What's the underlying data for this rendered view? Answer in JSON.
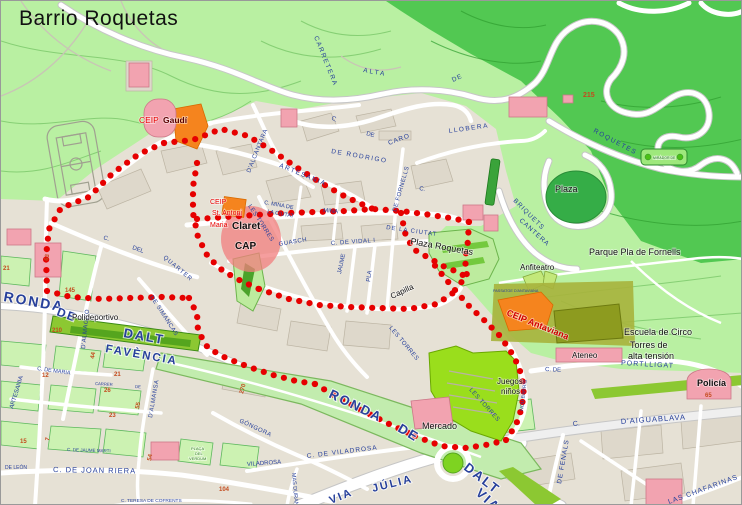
{
  "title": "Barrio Roquetas",
  "colors": {
    "parkLight": "#b9f0a2",
    "parkDark": "#52c852",
    "urban": "#e6e1d5",
    "block": "#ded8cb",
    "blockLine": "#bcb4a3",
    "greenBlock": "#ccf2b2",
    "greenBlockLine": "#5eb85e",
    "road": "#ffffff",
    "roadCase": "#c6c6c6",
    "band": "#c2ecae",
    "bandLine": "#7bb85e",
    "brightGreen": "#9ade1c",
    "sportGreen": "#8cc832",
    "sportDark": "#55a51e",
    "pink": "#f2a3b0",
    "pinkLine": "#cc7788",
    "orange": "#f5841e",
    "orangeLine": "#d86a00",
    "olive": "#8d9b1f",
    "khaki": "#a7b33c",
    "darkCircle": "#35ad47",
    "plazaGreen": "#bdeb9e",
    "plazaGreenLine": "#6cb44c",
    "contour": "#86cf74",
    "contourDark": "#2f9e2f",
    "grayTrail": "#c9c4b6",
    "blueLabel": "#27409b",
    "numColor": "#c44b1e",
    "route": "#e60000",
    "claretPink": "#f27d7d"
  },
  "route": {
    "color": "#e60000",
    "dot_radius": 3.1,
    "dot_spacing": 10.5,
    "polylines": [
      [
        [
          163,
          142
        ],
        [
          138,
          153
        ],
        [
          112,
          172
        ],
        [
          88,
          196
        ],
        [
          60,
          207
        ],
        [
          48,
          228
        ],
        [
          45,
          255
        ],
        [
          46,
          290
        ]
      ],
      [
        [
          46,
          290
        ],
        [
          70,
          296
        ],
        [
          100,
          298
        ],
        [
          130,
          297
        ],
        [
          160,
          296
        ],
        [
          188,
          297
        ]
      ],
      [
        [
          188,
          297
        ],
        [
          196,
          313
        ],
        [
          197,
          330
        ],
        [
          207,
          347
        ],
        [
          225,
          357
        ],
        [
          248,
          366
        ],
        [
          272,
          374
        ],
        [
          295,
          380
        ],
        [
          314,
          383
        ]
      ],
      [
        [
          314,
          383
        ],
        [
          338,
          397
        ],
        [
          362,
          410
        ],
        [
          388,
          423
        ],
        [
          414,
          435
        ]
      ],
      [
        [
          414,
          435
        ],
        [
          440,
          445
        ],
        [
          466,
          447
        ],
        [
          490,
          443
        ],
        [
          505,
          439
        ]
      ],
      [
        [
          505,
          439
        ],
        [
          515,
          424
        ],
        [
          521,
          406
        ],
        [
          523,
          386
        ],
        [
          518,
          366
        ],
        [
          509,
          349
        ],
        [
          498,
          334
        ],
        [
          484,
          320
        ],
        [
          469,
          306
        ],
        [
          453,
          288
        ],
        [
          439,
          271
        ],
        [
          428,
          257
        ]
      ],
      [
        [
          196,
          218
        ],
        [
          225,
          216
        ],
        [
          255,
          214
        ],
        [
          285,
          212
        ],
        [
          315,
          211
        ],
        [
          345,
          210
        ],
        [
          372,
          208
        ],
        [
          400,
          210
        ],
        [
          430,
          214
        ],
        [
          455,
          218
        ],
        [
          468,
          221
        ]
      ],
      [
        [
          163,
          142
        ],
        [
          192,
          139
        ],
        [
          220,
          128
        ],
        [
          247,
          135
        ],
        [
          270,
          149
        ],
        [
          295,
          166
        ],
        [
          320,
          182
        ],
        [
          345,
          196
        ],
        [
          372,
          208
        ]
      ],
      [
        [
          468,
          221
        ],
        [
          467,
          240
        ],
        [
          464,
          258
        ],
        [
          466,
          276
        ],
        [
          453,
          288
        ]
      ],
      [
        [
          196,
          162
        ],
        [
          192,
          186
        ],
        [
          192,
          212
        ],
        [
          197,
          236
        ],
        [
          207,
          256
        ],
        [
          222,
          270
        ],
        [
          240,
          280
        ],
        [
          258,
          288
        ]
      ],
      [
        [
          258,
          288
        ],
        [
          288,
          298
        ],
        [
          318,
          304
        ],
        [
          348,
          306
        ],
        [
          378,
          307
        ],
        [
          408,
          308
        ],
        [
          436,
          303
        ],
        [
          452,
          292
        ]
      ],
      [
        [
          400,
          212
        ],
        [
          404,
          232
        ],
        [
          412,
          248
        ],
        [
          428,
          257
        ],
        [
          444,
          266
        ],
        [
          459,
          272
        ],
        [
          466,
          277
        ]
      ]
    ]
  },
  "pois": [
    {
      "id": "ceip-gaudi",
      "label": "CEIP",
      "x": 138,
      "y": 122,
      "size": 8.5,
      "color": "#e80000",
      "bold": false
    },
    {
      "id": "ceip-gaudi-name",
      "label": "Gaudí",
      "x": 162,
      "y": 122,
      "size": 8.5,
      "color": "#5a0000",
      "bold": true
    },
    {
      "id": "ceip-claret",
      "label": "CEIP",
      "x": 209,
      "y": 203,
      "size": 7,
      "color": "#e80000"
    },
    {
      "id": "ceip-claret-2",
      "label": "St. Antoni",
      "x": 211,
      "y": 214,
      "size": 7,
      "color": "#e80000"
    },
    {
      "id": "ceip-claret-3",
      "label": "Maria",
      "x": 209,
      "y": 226,
      "size": 7,
      "color": "#e80000"
    },
    {
      "id": "ceip-claret-name",
      "label": "Claret",
      "x": 231,
      "y": 228,
      "size": 10,
      "color": "#111111",
      "bold": true
    },
    {
      "id": "cap",
      "label": "CAP",
      "x": 234,
      "y": 248,
      "size": 10,
      "color": "#111111",
      "bold": true
    },
    {
      "id": "plaza-roquetas",
      "label": "Plaza Roquetas",
      "x": 409,
      "y": 243,
      "size": 9,
      "color": "#111111",
      "rot": 10
    },
    {
      "id": "anfiteatro",
      "label": "Anfiteatro",
      "x": 519,
      "y": 269,
      "size": 8,
      "color": "#111111"
    },
    {
      "id": "parque-pla-de-fornells",
      "label": "Parque Pla de Fornells",
      "x": 588,
      "y": 254,
      "size": 9,
      "color": "#111111"
    },
    {
      "id": "plaza",
      "label": "Plaza",
      "x": 554,
      "y": 191,
      "size": 9,
      "color": "#111111"
    },
    {
      "id": "ceip-antaviana",
      "label": "CEIP Antaviana",
      "x": 505,
      "y": 314,
      "size": 9,
      "color": "#d00000",
      "bold": true,
      "rot": 22
    },
    {
      "id": "escuela-de-circo",
      "label": "Escuela de Circo",
      "x": 623,
      "y": 334,
      "size": 9,
      "color": "#111111"
    },
    {
      "id": "torres-alta-tension-1",
      "label": "Torres de",
      "x": 629,
      "y": 347,
      "size": 9,
      "color": "#111111"
    },
    {
      "id": "torres-alta-tension-2",
      "label": "alta tensión",
      "x": 627,
      "y": 358,
      "size": 9,
      "color": "#111111"
    },
    {
      "id": "ateneo",
      "label": "Ateneo",
      "x": 571,
      "y": 357,
      "size": 8,
      "color": "#111111"
    },
    {
      "id": "policia",
      "label": "Policía",
      "x": 696,
      "y": 385,
      "size": 9,
      "color": "#111111",
      "bold": true
    },
    {
      "id": "polideportivo",
      "label": "Polideportivo",
      "x": 71,
      "y": 319,
      "size": 8,
      "color": "#111111"
    },
    {
      "id": "mercado",
      "label": "Mercado",
      "x": 421,
      "y": 428,
      "size": 9,
      "color": "#111111"
    },
    {
      "id": "capilla",
      "label": "Capilla",
      "x": 391,
      "y": 298,
      "size": 8,
      "color": "#111111",
      "rot": -25
    },
    {
      "id": "juegos-ninos-1",
      "label": "Juegos",
      "x": 496,
      "y": 383,
      "size": 8,
      "color": "#111111"
    },
    {
      "id": "juegos-ninos-2",
      "label": "niños",
      "x": 500,
      "y": 393,
      "size": 8,
      "color": "#111111"
    },
    {
      "id": "mirador-sign",
      "label": "MIRADOR DE",
      "x": 652,
      "y": 158,
      "size": 3.5,
      "color": "#1d6b1d"
    },
    {
      "id": "placa-verdum-1",
      "label": "PLAÇA",
      "x": 190,
      "y": 449,
      "size": 4,
      "color": "#2f7d1f"
    },
    {
      "id": "placa-verdum-2",
      "label": "DEL",
      "x": 194,
      "y": 454,
      "size": 4,
      "color": "#2f7d1f"
    },
    {
      "id": "placa-verdum-3",
      "label": "VERDUM",
      "x": 188,
      "y": 459,
      "size": 4,
      "color": "#2f7d1f"
    }
  ],
  "street_labels": [
    {
      "label": "CARRETERA",
      "x": 313,
      "y": 36,
      "rot": 68,
      "size": 6.5,
      "ls": 1.5
    },
    {
      "label": "ALTA",
      "x": 362,
      "y": 71,
      "rot": 10,
      "size": 6.5,
      "ls": 2
    },
    {
      "label": "DE",
      "x": 452,
      "y": 81,
      "rot": -25,
      "size": 6.5,
      "ls": 1
    },
    {
      "label": "ROQUETES",
      "x": 592,
      "y": 131,
      "rot": 28,
      "size": 6.5,
      "ls": 1.5
    },
    {
      "label": "C.",
      "x": 330,
      "y": 118,
      "rot": 30,
      "size": 6
    },
    {
      "label": "DE",
      "x": 365,
      "y": 134,
      "rot": 15,
      "size": 6
    },
    {
      "label": "DE RODRIGO",
      "x": 330,
      "y": 152,
      "rot": 10,
      "size": 6.5,
      "ls": 1.5
    },
    {
      "label": "CARO",
      "x": 388,
      "y": 144,
      "rot": -20,
      "size": 6.5,
      "ls": 1
    },
    {
      "label": "LLOBERA",
      "x": 448,
      "y": 132,
      "rot": -8,
      "size": 6.5,
      "ls": 1.5
    },
    {
      "label": "BRIQUETS",
      "x": 512,
      "y": 200,
      "rot": 45,
      "size": 6.5,
      "ls": 1
    },
    {
      "label": "CANTERA",
      "x": 518,
      "y": 220,
      "rot": 42,
      "size": 6.5,
      "ls": 1
    },
    {
      "label": "ARTESANIA",
      "x": 278,
      "y": 166,
      "rot": 22,
      "size": 6.5,
      "ls": 1.5
    },
    {
      "label": "D'ALCANTARA",
      "x": 249,
      "y": 172,
      "rot": -68,
      "size": 6,
      "ls": 0.5
    },
    {
      "label": "C. MINA DE",
      "x": 263,
      "y": 203,
      "rot": 10,
      "size": 5.5
    },
    {
      "label": "LA CIUTAT",
      "x": 266,
      "y": 212,
      "rot": 10,
      "size": 5.5
    },
    {
      "label": "MINA",
      "x": 322,
      "y": 211,
      "rot": 5,
      "size": 6
    },
    {
      "label": "DE LA CIUTAT",
      "x": 385,
      "y": 228,
      "rot": 8,
      "size": 6,
      "ls": 1
    },
    {
      "label": "DE FORNELLS",
      "x": 395,
      "y": 211,
      "rot": -74,
      "size": 6,
      "ls": 0.5
    },
    {
      "label": "LES TORRES",
      "x": 247,
      "y": 205,
      "rot": 57,
      "size": 6,
      "ls": 0.5
    },
    {
      "label": "GUASCH",
      "x": 278,
      "y": 245,
      "rot": -10,
      "size": 6,
      "ls": 0.5
    },
    {
      "label": "C. DE VIDAL I",
      "x": 330,
      "y": 244,
      "rot": -4,
      "size": 6,
      "ls": 0.5
    },
    {
      "label": "JAUME",
      "x": 340,
      "y": 273,
      "rot": -78,
      "size": 6
    },
    {
      "label": "PLA",
      "x": 369,
      "y": 281,
      "rot": -82,
      "size": 6
    },
    {
      "label": "C.",
      "x": 102,
      "y": 238,
      "rot": 20,
      "size": 6
    },
    {
      "label": "DEL",
      "x": 131,
      "y": 248,
      "rot": 20,
      "size": 6
    },
    {
      "label": "QUARTER",
      "x": 162,
      "y": 257,
      "rot": 40,
      "size": 6,
      "ls": 1
    },
    {
      "label": "DE SIMANCAS",
      "x": 149,
      "y": 296,
      "rot": 57,
      "size": 6,
      "ls": 0.5
    },
    {
      "label": "D'ALMAGRO",
      "x": 84,
      "y": 348,
      "rot": -84,
      "size": 6,
      "ls": 0.5
    },
    {
      "label": "D'ALMANSA",
      "x": 151,
      "y": 417,
      "rot": -80,
      "size": 6,
      "ls": 0.5
    },
    {
      "label": "C. DE MARIA",
      "x": 36,
      "y": 369,
      "rot": 8,
      "size": 5.5
    },
    {
      "label": "ARTESANIA",
      "x": 12,
      "y": 408,
      "rot": -73,
      "size": 6
    },
    {
      "label": "GÓNGORA",
      "x": 238,
      "y": 421,
      "rot": 25,
      "size": 6,
      "ls": 0.5
    },
    {
      "label": "MAS DURAN",
      "x": 291,
      "y": 472,
      "rot": 85,
      "size": 5.5
    },
    {
      "label": "C. DE VILADROSA",
      "x": 306,
      "y": 457,
      "rot": -7,
      "size": 6.5,
      "ls": 1
    },
    {
      "label": "VILADROSA",
      "x": 246,
      "y": 465,
      "rot": -4,
      "size": 6
    },
    {
      "label": "C. DE JOAN RIERA",
      "x": 52,
      "y": 471,
      "rot": 1,
      "size": 7.5,
      "ls": 1
    },
    {
      "label": "DE LEÓN",
      "x": 4,
      "y": 468,
      "rot": 0,
      "size": 5
    },
    {
      "label": "C. TERESA DE COFRENTS",
      "x": 120,
      "y": 501,
      "rot": 0,
      "size": 4.8
    },
    {
      "label": "C. DE JAUME MARTI",
      "x": 66,
      "y": 450,
      "rot": 2,
      "size": 4.5
    },
    {
      "label": "CARRER",
      "x": 94,
      "y": 384,
      "rot": 3,
      "size": 4.2
    },
    {
      "label": "DE",
      "x": 134,
      "y": 387,
      "rot": 3,
      "size": 4.2
    },
    {
      "label": "D'AIGUABLAVA",
      "x": 620,
      "y": 423,
      "rot": -4,
      "size": 7.5,
      "ls": 1
    },
    {
      "label": "C.",
      "x": 572,
      "y": 425,
      "rot": -5,
      "size": 7
    },
    {
      "label": "DE FENALS",
      "x": 560,
      "y": 483,
      "rot": -80,
      "size": 6.5,
      "ls": 1
    },
    {
      "label": "LAS CHAFARINAS",
      "x": 668,
      "y": 503,
      "rot": -20,
      "size": 7,
      "ls": 1
    },
    {
      "label": "C. DE",
      "x": 544,
      "y": 370,
      "rot": 3,
      "size": 6
    },
    {
      "label": "PORTLLIGAT",
      "x": 620,
      "y": 364,
      "rot": 3,
      "size": 7,
      "ls": 1
    },
    {
      "label": "NOU BARRIS",
      "x": 522,
      "y": 410,
      "rot": -83,
      "size": 5
    },
    {
      "label": "LES TORRES",
      "x": 388,
      "y": 327,
      "rot": 50,
      "size": 6,
      "ls": 0.5
    },
    {
      "label": "LES TORRES",
      "x": 468,
      "y": 389,
      "rot": 48,
      "size": 6,
      "ls": 0.5
    },
    {
      "label": "C.",
      "x": 418,
      "y": 189,
      "rot": 10,
      "size": 6
    },
    {
      "label": "PASSATGE D'ANTAVIANA",
      "x": 492,
      "y": 291,
      "rot": 0,
      "size": 3.8
    }
  ],
  "major_labels": [
    {
      "label": "RONDA",
      "x": 2,
      "y": 300,
      "rot": 10,
      "size": 14
    },
    {
      "label": "DE",
      "x": 55,
      "y": 314,
      "rot": 20,
      "size": 12
    },
    {
      "label": "DALT",
      "x": 122,
      "y": 336,
      "rot": 10,
      "size": 13
    },
    {
      "label": "FAVÈNCIA",
      "x": 104,
      "y": 351,
      "rot": 10,
      "size": 11.5
    },
    {
      "label": "RONDA",
      "x": 327,
      "y": 396,
      "rot": 26,
      "size": 13
    },
    {
      "label": "DE",
      "x": 396,
      "y": 430,
      "rot": 30,
      "size": 13
    },
    {
      "label": "DALT",
      "x": 462,
      "y": 468,
      "rot": 38,
      "size": 13
    },
    {
      "label": "VIA",
      "x": 474,
      "y": 493,
      "rot": 42,
      "size": 13
    },
    {
      "label": "VIA",
      "x": 330,
      "y": 503,
      "rot": -22,
      "size": 11
    },
    {
      "label": "JÚLIA",
      "x": 372,
      "y": 491,
      "rot": -14,
      "size": 11
    }
  ],
  "house_numbers": [
    {
      "label": "215",
      "x": 582,
      "y": 96,
      "rot": 0,
      "size": 7
    },
    {
      "label": "63",
      "x": 47,
      "y": 260,
      "rot": -80,
      "size": 6
    },
    {
      "label": "21",
      "x": 2,
      "y": 269,
      "rot": 0,
      "size": 6
    },
    {
      "label": "145",
      "x": 64,
      "y": 291,
      "rot": 0,
      "size": 6
    },
    {
      "label": "210",
      "x": 51,
      "y": 331,
      "rot": 0,
      "size": 6
    },
    {
      "label": "44",
      "x": 93,
      "y": 358,
      "rot": -80,
      "size": 6
    },
    {
      "label": "12",
      "x": 41,
      "y": 376,
      "rot": 0,
      "size": 6
    },
    {
      "label": "21",
      "x": 113,
      "y": 375,
      "rot": 0,
      "size": 6
    },
    {
      "label": "26",
      "x": 103,
      "y": 391,
      "rot": 0,
      "size": 6
    },
    {
      "label": "55",
      "x": 138,
      "y": 408,
      "rot": -80,
      "size": 6
    },
    {
      "label": "23",
      "x": 108,
      "y": 416,
      "rot": 0,
      "size": 6
    },
    {
      "label": "15",
      "x": 19,
      "y": 442,
      "rot": 0,
      "size": 6
    },
    {
      "label": "7",
      "x": 48,
      "y": 440,
      "rot": -80,
      "size": 6
    },
    {
      "label": "54",
      "x": 150,
      "y": 460,
      "rot": -80,
      "size": 6
    },
    {
      "label": "104",
      "x": 218,
      "y": 490,
      "rot": 0,
      "size": 6
    },
    {
      "label": "270",
      "x": 242,
      "y": 393,
      "rot": -75,
      "size": 6
    },
    {
      "label": "65",
      "x": 704,
      "y": 396,
      "rot": 0,
      "size": 6
    }
  ]
}
